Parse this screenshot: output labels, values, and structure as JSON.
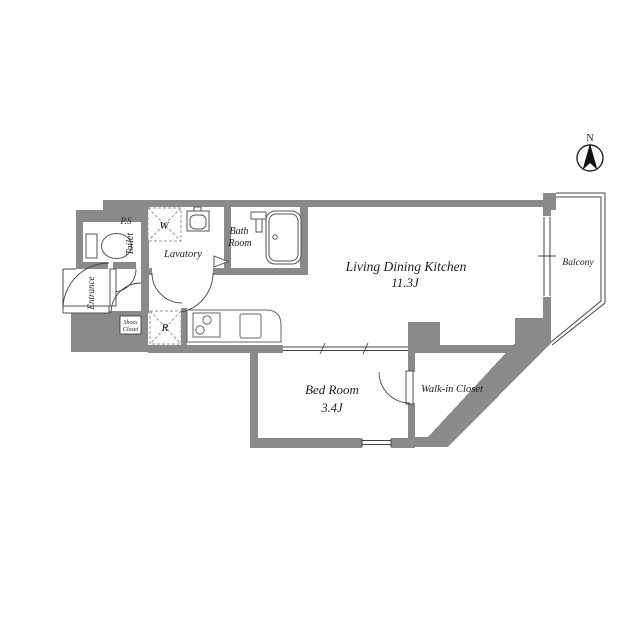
{
  "plan": {
    "rooms": {
      "ldk": {
        "name": "Living Dining Kitchen",
        "size": "11.3J"
      },
      "bedroom": {
        "name": "Bed Room",
        "size": "3.4J"
      },
      "walk_in_closet": {
        "name": "Walk-in Closet"
      },
      "balcony": {
        "name": "Balcony"
      },
      "bath": {
        "name_line1": "Bath",
        "name_line2": "Room"
      },
      "lavatory": {
        "name": "Lavatory"
      },
      "toilet": {
        "name": "Toilet"
      },
      "entrance": {
        "name": "Entrance"
      },
      "shoes_closet": {
        "line1": "Shoes",
        "line2": "Closet"
      },
      "pipe_space": {
        "name": "P.S"
      }
    },
    "appliances": {
      "washer": "W",
      "refrigerator": "R"
    },
    "compass": {
      "north": "N"
    },
    "colors": {
      "wall": "#8a8a8a",
      "line": "#444444",
      "text": "#1b1b1b"
    }
  }
}
